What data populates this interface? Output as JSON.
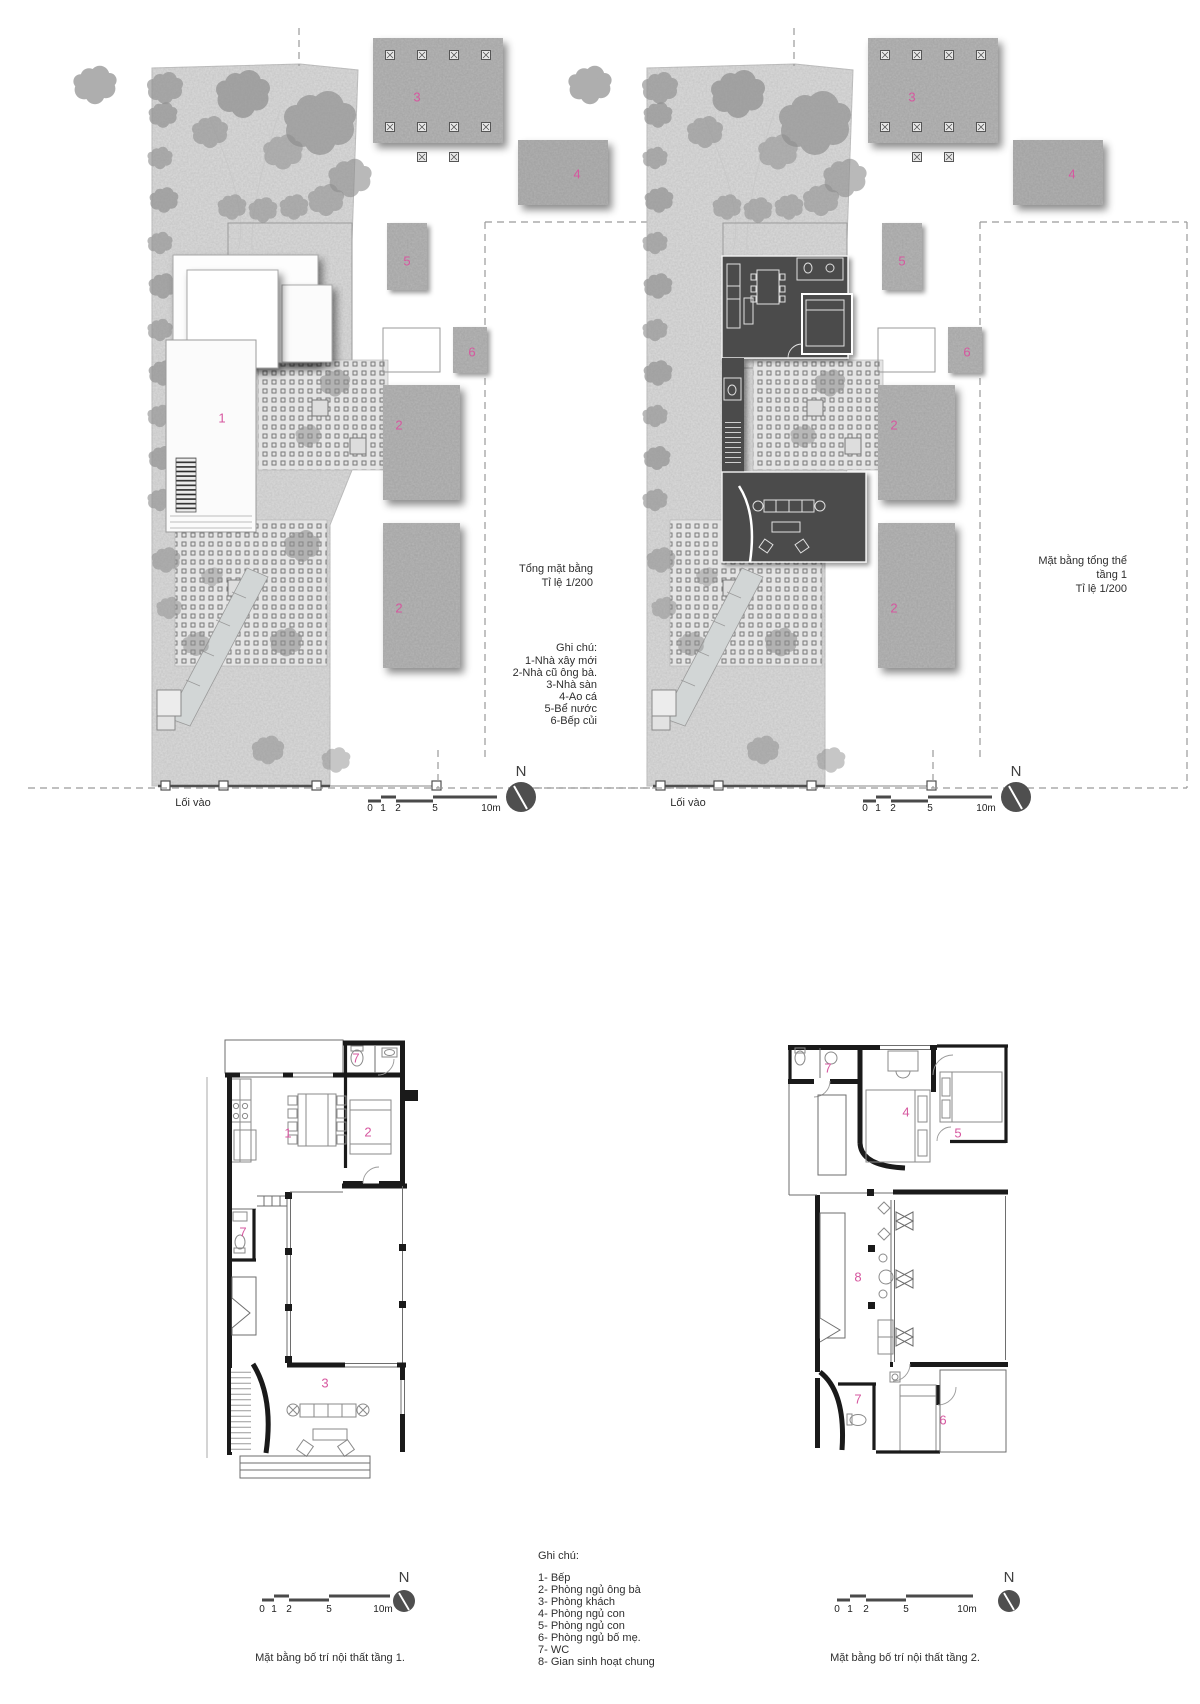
{
  "page": {
    "background": "#ffffff"
  },
  "colors": {
    "accent_pink": "#d6579f",
    "wall_black": "#1a1a1a",
    "site_ground": "#dcdcdc",
    "building_gray": "#b7b7b7",
    "dark_plan_fill": "#4b4b4b",
    "compass_gray": "#4f4f4f"
  },
  "scale_bar": {
    "labels": [
      "0",
      "1",
      "2",
      "5",
      "10m"
    ]
  },
  "compass": {
    "label": "N"
  },
  "site_plan_left": {
    "title_lines": [
      "Tổng mặt bằng",
      "Tỉ lệ 1/200"
    ],
    "entrance_label": "Lối vào",
    "legend_title": "Ghi chú:",
    "legend_items": [
      "1-Nhà xây mới",
      "2-Nhà cũ ông bà.",
      "3-Nhà sàn",
      "4-Ao cá",
      "5-Bể nước",
      "6-Bếp củi"
    ],
    "numbers": {
      "new_house": "1",
      "old_house_a": "2",
      "old_house_b": "2",
      "stilt_house": "3",
      "fish_pond": "4",
      "water_tank": "5",
      "wood_kitchen": "6"
    }
  },
  "site_plan_right": {
    "title_lines": [
      "Mặt bằng tổng thể",
      "tầng 1",
      "Tỉ lệ 1/200"
    ],
    "entrance_label": "Lối vào",
    "numbers": {
      "old_house_a": "2",
      "old_house_b": "2",
      "stilt_house": "3",
      "fish_pond": "4",
      "water_tank": "5",
      "wood_kitchen": "6"
    }
  },
  "floor_plan_1": {
    "caption": "Mặt bằng bố trí nội thất tầng 1.",
    "numbers": {
      "kitchen": "1",
      "bedroom": "2",
      "living": "3",
      "wc_upper": "7",
      "wc_lower": "7"
    }
  },
  "floor_plan_2": {
    "caption": "Mặt bằng bố trí nội thất tầng 2.",
    "numbers": {
      "wc_upper": "7",
      "bedroom_4": "4",
      "bedroom_5": "5",
      "common_area": "8",
      "wc_lower": "7",
      "bedroom_6": "6"
    }
  },
  "room_legend": {
    "title": "Ghi chú:",
    "items": [
      "1- Bếp",
      "2- Phòng ngủ ông bà",
      "3- Phòng khách",
      "4- Phòng ngủ con",
      "5- Phòng ngủ con",
      "6- Phòng ngủ bố mẹ.",
      "7- WC",
      "8- Gian sinh hoạt chung"
    ]
  }
}
